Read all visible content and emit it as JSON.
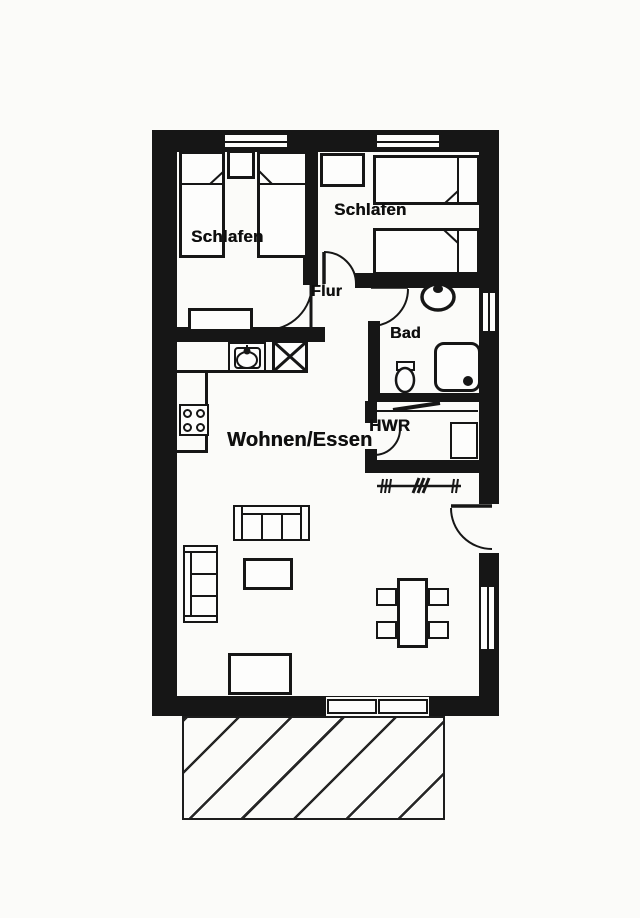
{
  "colors": {
    "ink": "#161616",
    "paper": "#fbfbf9"
  },
  "rooms": {
    "bedroom_left": {
      "label": "Schlafen"
    },
    "bedroom_right": {
      "label": "Schlafen"
    },
    "hallway": {
      "label": "Flur"
    },
    "bathroom": {
      "label": "Bad"
    },
    "utility_room": {
      "label": "HWR"
    },
    "living_dining": {
      "label": "Wohnen/Essen"
    }
  }
}
